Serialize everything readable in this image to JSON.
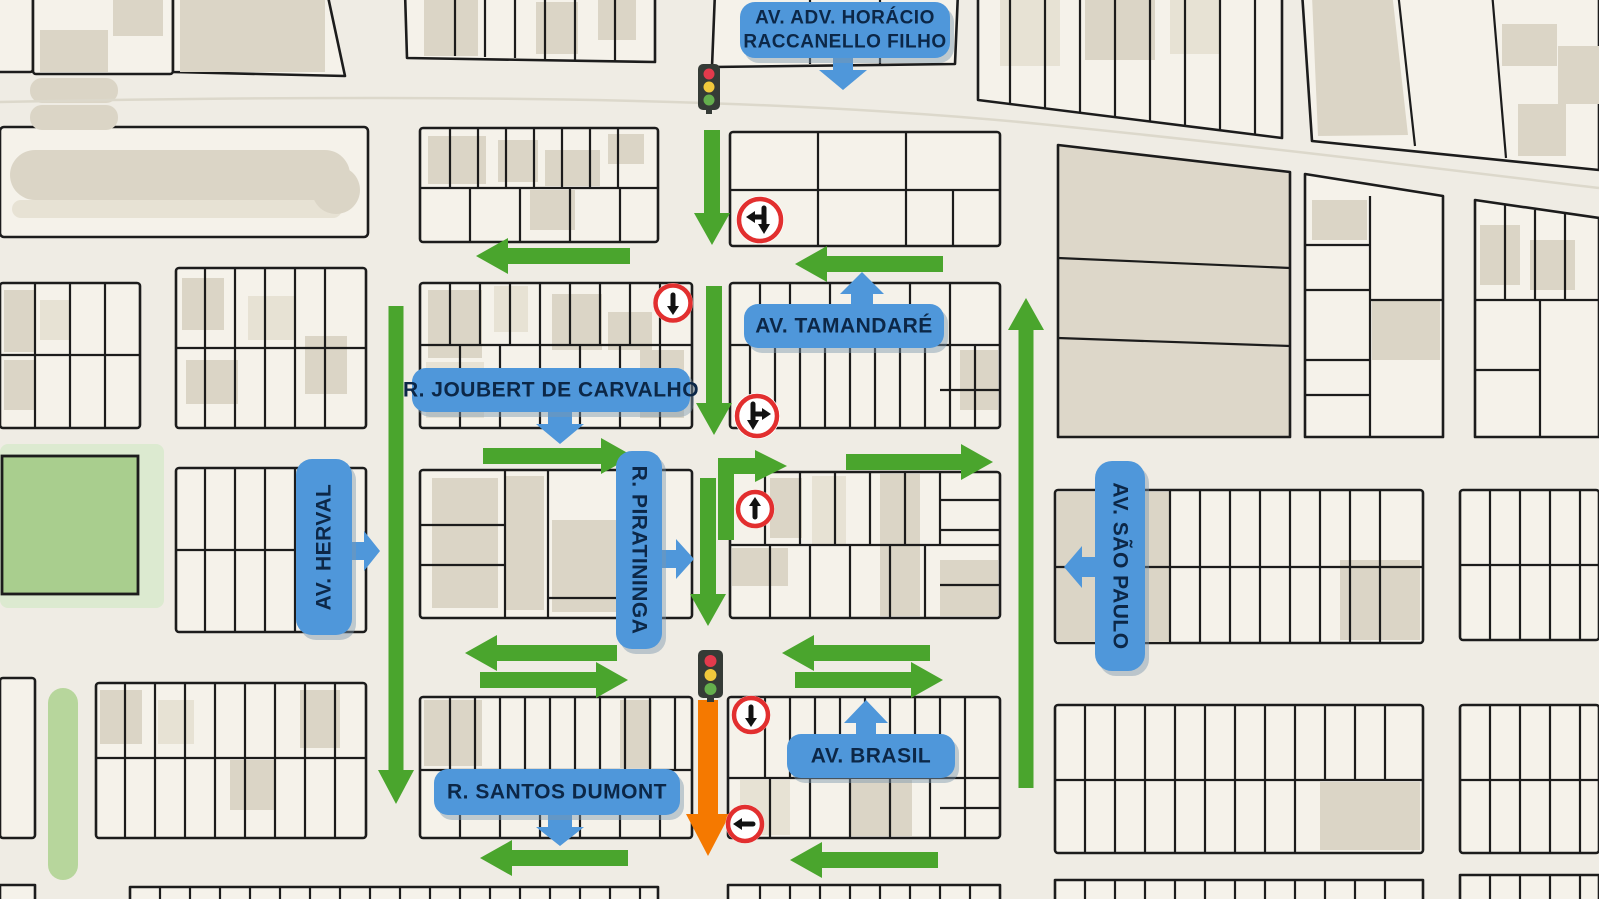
{
  "title": "One-way traffic flow map of downtown streets",
  "streets": [
    {
      "id": "horacio",
      "name": "AV. ADV. HORÁCIO RACCANELLO FILHO",
      "line1": "AV. ADV. HORÁCIO",
      "line2": "RACCANELLO FILHO",
      "label_orientation": "horizontal",
      "pointer": "down"
    },
    {
      "id": "tamandare",
      "name": "AV. TAMANDARÉ",
      "label_orientation": "horizontal",
      "pointer": "up"
    },
    {
      "id": "joubert",
      "name": "R. JOUBERT DE CARVALHO",
      "label_orientation": "horizontal",
      "pointer": "down"
    },
    {
      "id": "herval",
      "name": "AV. HERVAL",
      "label_orientation": "vertical",
      "pointer": "right"
    },
    {
      "id": "piratininga",
      "name": "R. PIRATININGA",
      "label_orientation": "vertical",
      "pointer": "right"
    },
    {
      "id": "brasil",
      "name": "AV. BRASIL",
      "label_orientation": "horizontal",
      "pointer": "up"
    },
    {
      "id": "santos-dumont",
      "name": "R. SANTOS DUMONT",
      "label_orientation": "horizontal",
      "pointer": "down"
    },
    {
      "id": "sao-paulo",
      "name": "AV. SÃO PAULO",
      "label_orientation": "vertical",
      "pointer": "left"
    }
  ],
  "traffic_lights": [
    {
      "id": "signal-north",
      "lights": [
        "red",
        "yellow",
        "green"
      ]
    },
    {
      "id": "signal-south",
      "lights": [
        "red",
        "yellow",
        "green"
      ]
    }
  ],
  "regulatory_signs": [
    {
      "id": "sign-1",
      "meaning": "straight-ahead-or-left-turn"
    },
    {
      "id": "sign-2",
      "meaning": "straight-ahead-only-down"
    },
    {
      "id": "sign-3",
      "meaning": "straight-ahead-or-right-turn"
    },
    {
      "id": "sign-4",
      "meaning": "straight-ahead-only-up"
    },
    {
      "id": "sign-5",
      "meaning": "straight-ahead-only-down"
    },
    {
      "id": "sign-6",
      "meaning": "left-turn-only"
    }
  ],
  "flow_arrows": {
    "green_one_way_count": 16,
    "orange_highlight_count": 1
  },
  "colors": {
    "background": "#efece4",
    "block_fill": "#f5f2ea",
    "block_outline": "#1c1c1c",
    "building_tan": "#dbd5c6",
    "park_green": "#a9ce8e",
    "badge_blue": "#4f97da",
    "badge_text_navy": "#0c2747",
    "arrow_green": "#4aa52d",
    "arrow_orange": "#f57900",
    "sign_ring_red": "#e22f2f",
    "traffic_light_body": "#353b36",
    "traffic_red": "#e23a4c",
    "traffic_yellow": "#f0c83c",
    "traffic_green": "#64ae4d"
  }
}
